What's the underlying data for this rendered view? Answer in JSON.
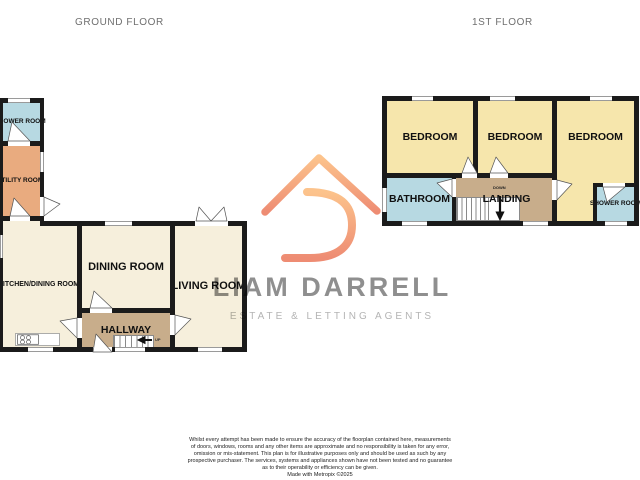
{
  "titles": {
    "ground": "GROUND FLOOR",
    "first": "1ST FLOOR"
  },
  "ground_floor": {
    "shower_room": "SHOWER ROOM",
    "utility_room": "UTILITY ROOM",
    "kitchen_dining_room": "KITCHEN/DINING ROOM",
    "dining_room": "DINING ROOM",
    "hallway": "HALLWAY",
    "living_room": "LIVING ROOM",
    "stairs_up": "UP"
  },
  "first_floor": {
    "bedroom_left": "BEDROOM",
    "bedroom_middle": "BEDROOM",
    "bedroom_right": "BEDROOM",
    "bathroom": "BATHROOM",
    "landing": "LANDING",
    "shower_room": "SHOWER ROOM",
    "stairs_down": "DOWN"
  },
  "watermark": {
    "name": "LIAM DARRELL",
    "tagline": "ESTATE & LETTING AGENTS"
  },
  "footer": {
    "lines": [
      "Whilst every attempt has been made to ensure the accuracy of the floorplan contained here, measurements",
      "of doors, windows, rooms and any other items are approximate and no responsibility is taken for any error,",
      "omission or mis-statement. This plan is for illustrative purposes only and should be used as such by any",
      "prospective purchaser. The services, systems and appliances shown have not been tested and no guarantee",
      "as to their operability or efficiency can be given.",
      "Made with Metropix ©2025"
    ]
  },
  "colors": {
    "wall": "#1b1b1b",
    "cream_room": "#f6efdc",
    "yellow_room": "#f6e6ac",
    "blue_room": "#b7d9e2",
    "orange_room": "#e9ab7f",
    "tan_hall": "#c8ad8b",
    "logo_top": "#fcc38c",
    "logo_bottom": "#ee8c73",
    "brand_gray": "#8f8f8f"
  }
}
